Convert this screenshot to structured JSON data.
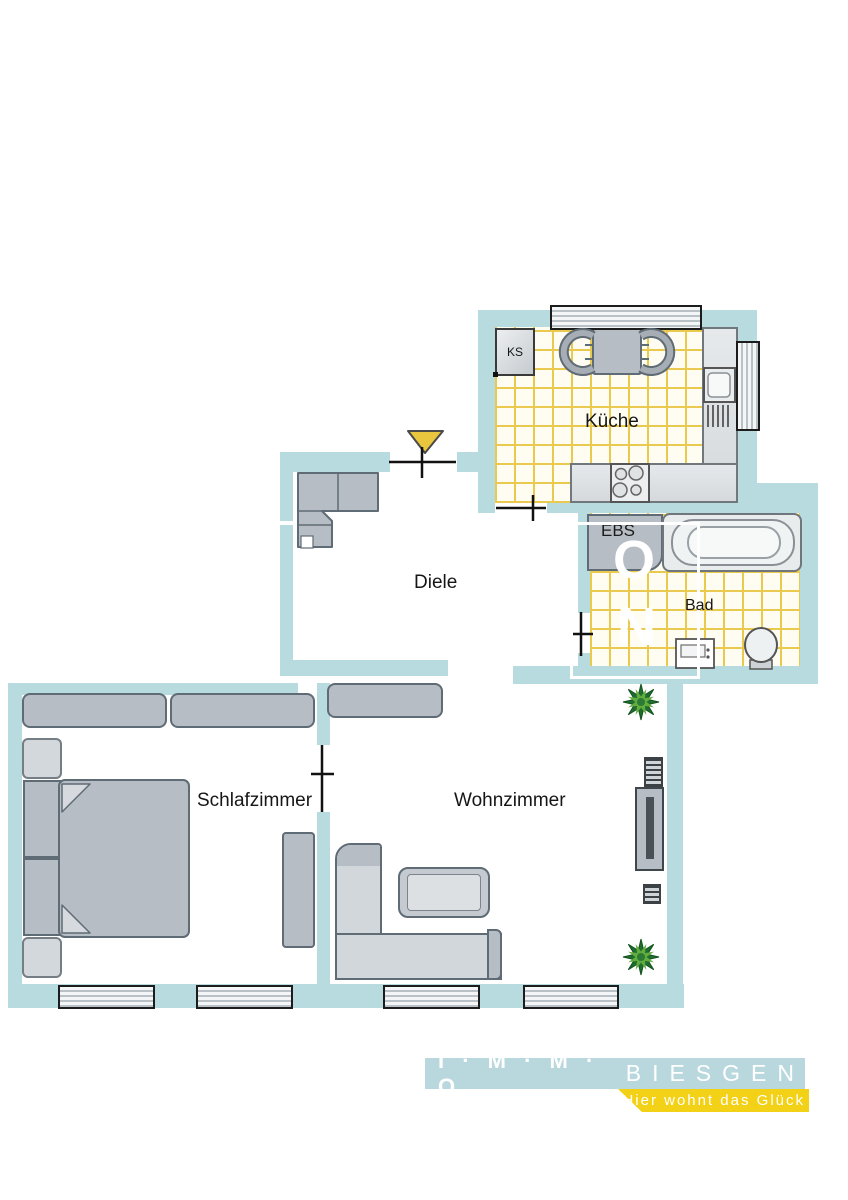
{
  "plan": {
    "rooms": {
      "kueche": "Küche",
      "diele": "Diele",
      "bad": "Bad",
      "schlafzimmer": "Schlafzimmer",
      "wohnzimmer": "Wohnzimmer"
    },
    "fixtures": {
      "fridge": "KS",
      "built_in": "EBS"
    },
    "watermark": {
      "top": "O",
      "bottom": "N"
    }
  },
  "logo": {
    "brand_bold": "I · M · M · O",
    "brand_light": "BIESGEN",
    "tagline": "Hier wohnt das Glück"
  },
  "colors": {
    "wall": "#b7dbdf",
    "tile_line": "#eac94f",
    "furniture": "#b7bdc4",
    "entrance_arrow": "#e9c63d",
    "logo_blue": "#b9d8de",
    "logo_yellow": "#f2d117"
  }
}
